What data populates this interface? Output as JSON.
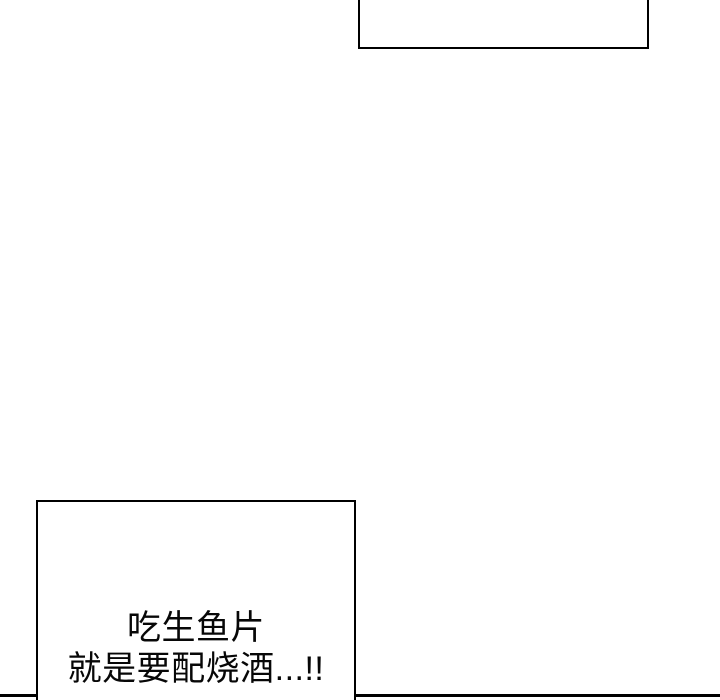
{
  "page": {
    "background_color": "#ffffff",
    "line_color": "#000000"
  },
  "top_bubble": {
    "text": ""
  },
  "bottom_bubble": {
    "lines": [
      "吃生鱼片",
      "就是要配烧酒...!!"
    ]
  }
}
